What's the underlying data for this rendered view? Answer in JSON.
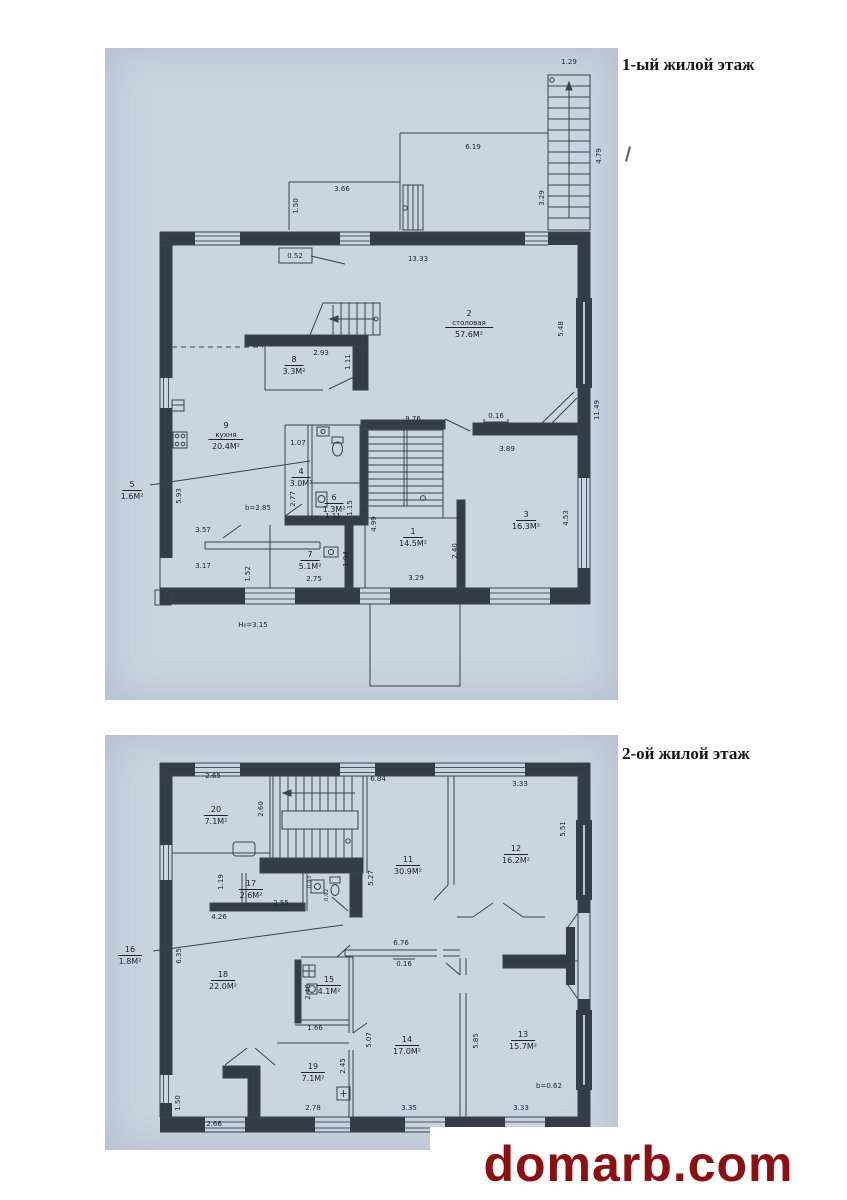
{
  "page": {
    "floor1_title": "1-ый жилой этаж",
    "floor2_title": "2-ой жилой этаж",
    "watermark": "domarb.com",
    "plan_background_color": "#cbd4e1",
    "line_color": "#343c49",
    "watermark_color": "#8e0f12"
  },
  "floor1": {
    "rooms": {
      "r1": {
        "num": "1",
        "area": "14.5М²"
      },
      "r2": {
        "num": "2",
        "name": "столовая",
        "area": "57.6М²"
      },
      "r3": {
        "num": "3",
        "area": "16.3М²"
      },
      "r4": {
        "num": "4",
        "area": "3.0М²"
      },
      "r5": {
        "num": "5",
        "area": "1.6М²"
      },
      "r6": {
        "num": "6",
        "area": "1.3М²"
      },
      "r7": {
        "num": "7",
        "area": "5.1М²"
      },
      "r8": {
        "num": "8",
        "area": "3.3М²"
      },
      "r9": {
        "num": "9",
        "name": "кухня",
        "area": "20.4М²"
      }
    },
    "dims": [
      "1.29",
      "4.79",
      "3.29",
      "6.19",
      "3.66",
      "1.50",
      "0.52",
      "13.33",
      "2.93",
      "1.11",
      "1.07",
      "2.77",
      "1.11",
      "1.15",
      "2.75",
      "1.94",
      "4.99",
      "3.29",
      "2.40",
      "9.76",
      "0.16",
      "3.89",
      "5.48",
      "11.49",
      "4.53",
      "5.93",
      "b=2.85",
      "3.57",
      "3.17",
      "1.52",
      "Н₀=3.15"
    ]
  },
  "floor2": {
    "rooms": {
      "r11": {
        "num": "11",
        "area": "30.9М²"
      },
      "r12": {
        "num": "12",
        "area": "16.2М²"
      },
      "r13": {
        "num": "13",
        "area": "15.7М²"
      },
      "r14": {
        "num": "14",
        "area": "17.0М²"
      },
      "r15": {
        "num": "15",
        "area": "4.1М²"
      },
      "r16": {
        "num": "16",
        "area": "1.8М²"
      },
      "r17": {
        "num": "17",
        "area": "2.6М²"
      },
      "r18": {
        "num": "18",
        "area": "22.0М²"
      },
      "r19": {
        "num": "19",
        "area": "7.1М²"
      },
      "r20": {
        "num": "20",
        "area": "7.1М²"
      }
    },
    "dims": [
      "2.65",
      "2.60",
      "6.84",
      "3.33",
      "5.51",
      "1.19",
      "2.55",
      "4.26",
      "0.93",
      "0.92",
      "5.27",
      "6.35",
      "2.46",
      "1.66",
      "6.76",
      "0.16",
      "5.07",
      "5.85",
      "2.45",
      "2.78",
      "3.35",
      "3.33",
      "b=0.62",
      "1.50",
      "2.66"
    ]
  }
}
